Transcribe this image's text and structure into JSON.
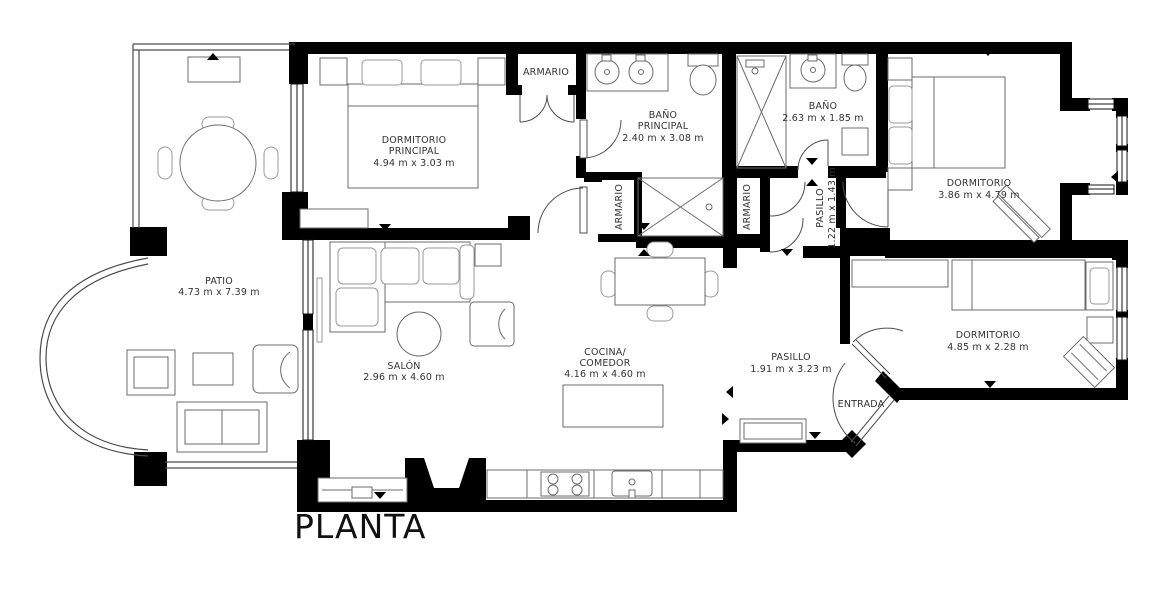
{
  "title": "PLANTA",
  "rooms": {
    "patio": {
      "name": "PATIO",
      "dims": "4.73 m x 7.39 m"
    },
    "dormitorio_principal": {
      "name": "DORMITORIO",
      "name2": "PRINCIPAL",
      "dims": "4.94 m x 3.03 m"
    },
    "armario_top": {
      "name": "ARMARIO"
    },
    "bano_principal": {
      "name": "BAÑO",
      "name2": "PRINCIPAL",
      "dims": "2.40 m x 3.08 m"
    },
    "bano": {
      "name": "BAÑO",
      "dims": "2.63 m x 1.85 m"
    },
    "armario_izq": {
      "name": "ARMARIO"
    },
    "armario_der": {
      "name": "ARMARIO"
    },
    "pasillo_pequeno": {
      "name": "PASILLO",
      "dims": "1.22 m x 1.43 m"
    },
    "salon": {
      "name": "SALÓN",
      "dims": "2.96 m x 4.60 m"
    },
    "cocina_comedor": {
      "name": "COCINA/",
      "name2": "COMEDOR",
      "dims": "4.16 m x 4.60 m"
    },
    "pasillo": {
      "name": "PASILLO",
      "dims": "1.91 m x 3.23 m"
    },
    "entrada": {
      "name": "ENTRADA"
    },
    "dormitorio_derecha": {
      "name": "DORMITORIO",
      "dims": "3.86 m x 4.79 m"
    },
    "dormitorio_inferior": {
      "name": "DORMITORIO",
      "dims": "4.85 m x 2.28 m"
    }
  },
  "colors": {
    "wall": "#000000",
    "text": "#333333",
    "background": "#ffffff"
  }
}
